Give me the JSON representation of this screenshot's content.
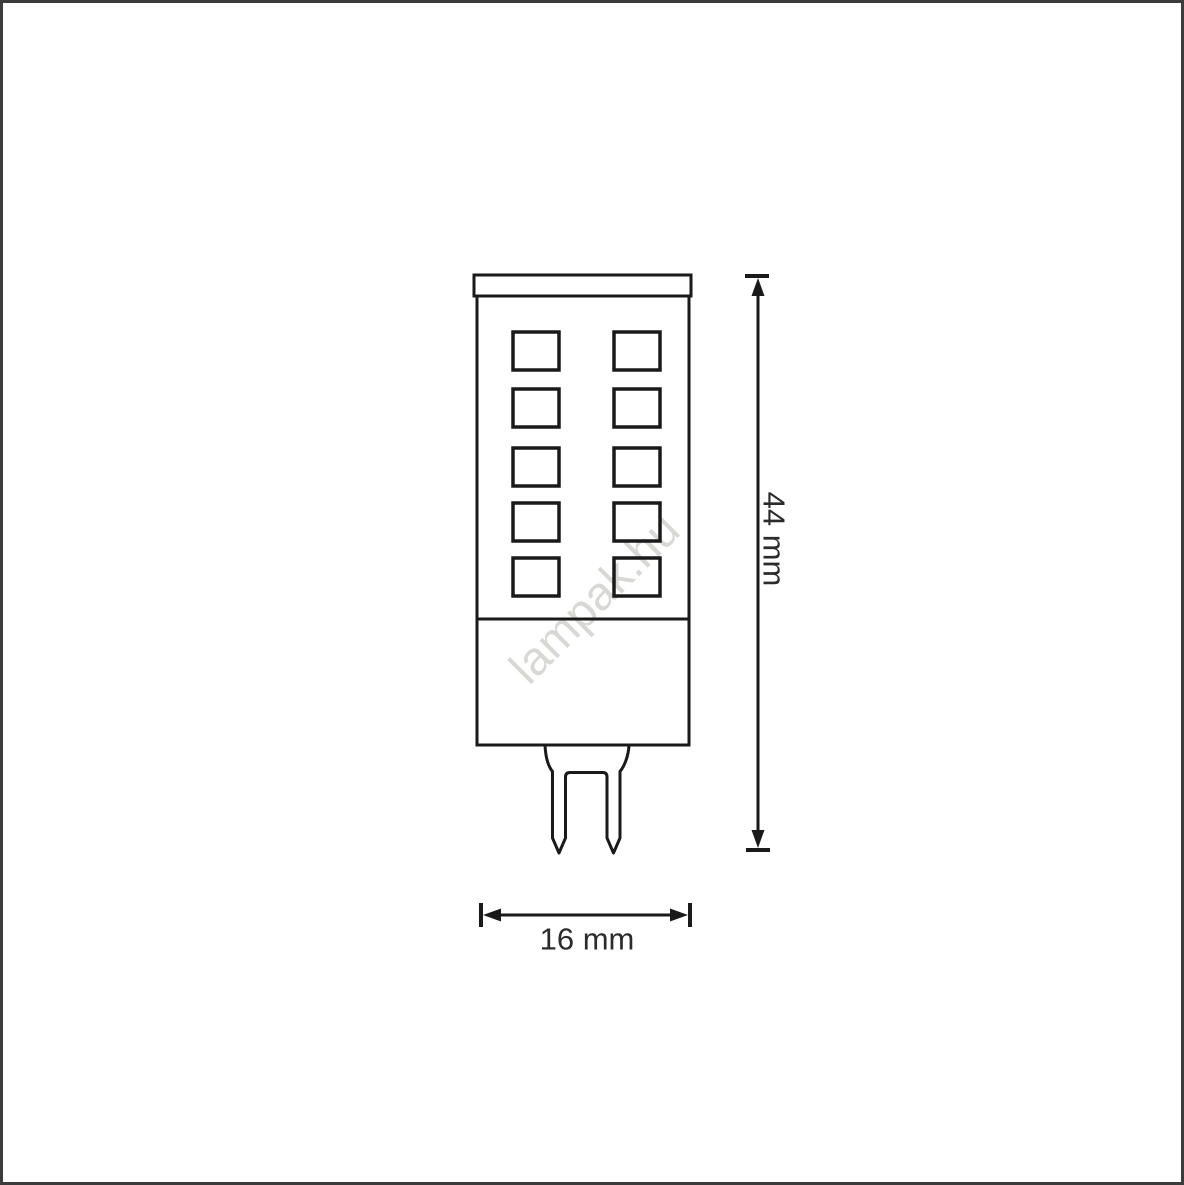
{
  "diagram": {
    "watermark": "lampak.hu",
    "dimensions": {
      "height": {
        "label": "44 mm"
      },
      "width": {
        "label": "16 mm"
      }
    },
    "led_grid": {
      "rows": 5,
      "columns": 2
    },
    "colors": {
      "line": "#1a1a1a",
      "frame": "#3b3b3b",
      "watermark": "#d8d8d5",
      "text": "#2b2b2b"
    }
  }
}
